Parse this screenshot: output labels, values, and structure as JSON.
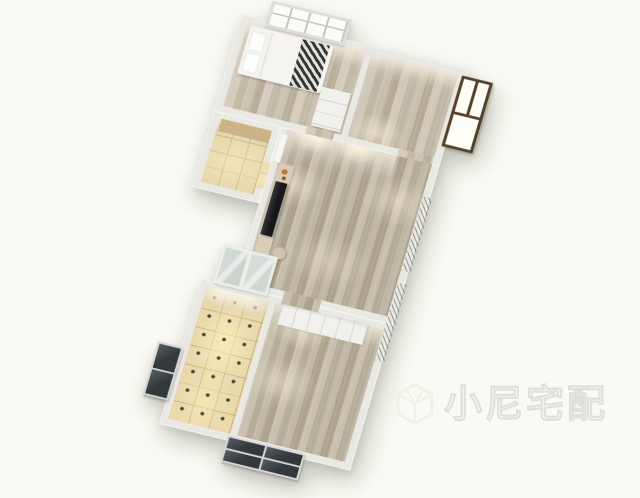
{
  "watermark": {
    "text": "小尼宅配",
    "logo_icon": "isometric-cube-logo"
  },
  "scene": {
    "type": "3d-floor-plan-render",
    "view": "axonometric, plan rotated ~15 degrees"
  },
  "colors": {
    "bg": "#fafaf4",
    "wall": "#e9e8e3",
    "tile": "#e6d5a9",
    "grout": "#c6b27e",
    "frameBrown": "#54402a",
    "paneWhite": "#fffef6",
    "frameLight": "#d6d8d6",
    "glassDark": "#33383d",
    "bench": "#d9cdb8",
    "tv": "#18181a",
    "bedWhite": "#f5f4f0",
    "blanketDark": "#3b3b38",
    "watermark": "rgba(255,255,255,0.92)",
    "watermarkStroke": "rgba(205,205,196,0.6)"
  }
}
